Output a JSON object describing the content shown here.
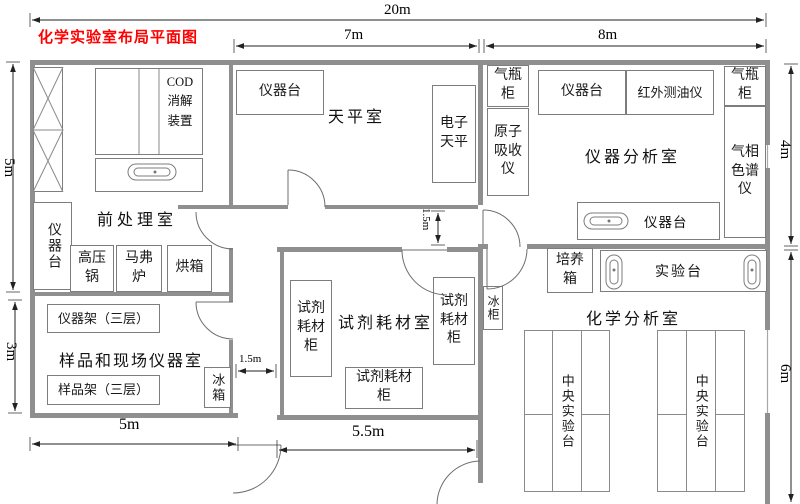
{
  "title": "化学实验室布局平面图",
  "rooms": {
    "pretreatment": "前处理室",
    "balance": "天平室",
    "instrument": "仪器分析室",
    "reagent": "试剂耗材室",
    "sample": "样品和现场仪器室",
    "chemical": "化学分析室"
  },
  "equipment": {
    "cod_digester": "COD消解装置",
    "bench": "仪器台",
    "electronic_balance": "电子天平",
    "gas_cabinet": "气瓶柜",
    "atomic_absorption": "原子吸收仪",
    "infrared_oil": "红外测油仪",
    "gas_chromatograph": "气相色谱仪",
    "autoclave": "高压锅",
    "muffle_furnace": "马弗炉",
    "oven": "烘箱",
    "instrument_rack": "仪器架（三层）",
    "sample_rack": "样品架（三层）",
    "fridge": "冰箱",
    "freezer": "冰柜",
    "reagent_cabinet": "试剂耗材柜",
    "incubator": "培养箱",
    "lab_bench": "实验台",
    "central_bench": "中央实验台"
  },
  "dims": {
    "total_width": "20m",
    "balance_width": "7m",
    "instrument_width": "8m",
    "pretreat_height": "5m",
    "sample_height": "3m",
    "instrument_height": "4m",
    "chemical_height": "6m",
    "sample_width": "5m",
    "hall_width": "5.5m",
    "corridor_width": "1.5m",
    "corridor_height": "1.5m"
  },
  "colors": {
    "title_red": "#ff0000",
    "wall_gray": "#8f8f8f"
  }
}
